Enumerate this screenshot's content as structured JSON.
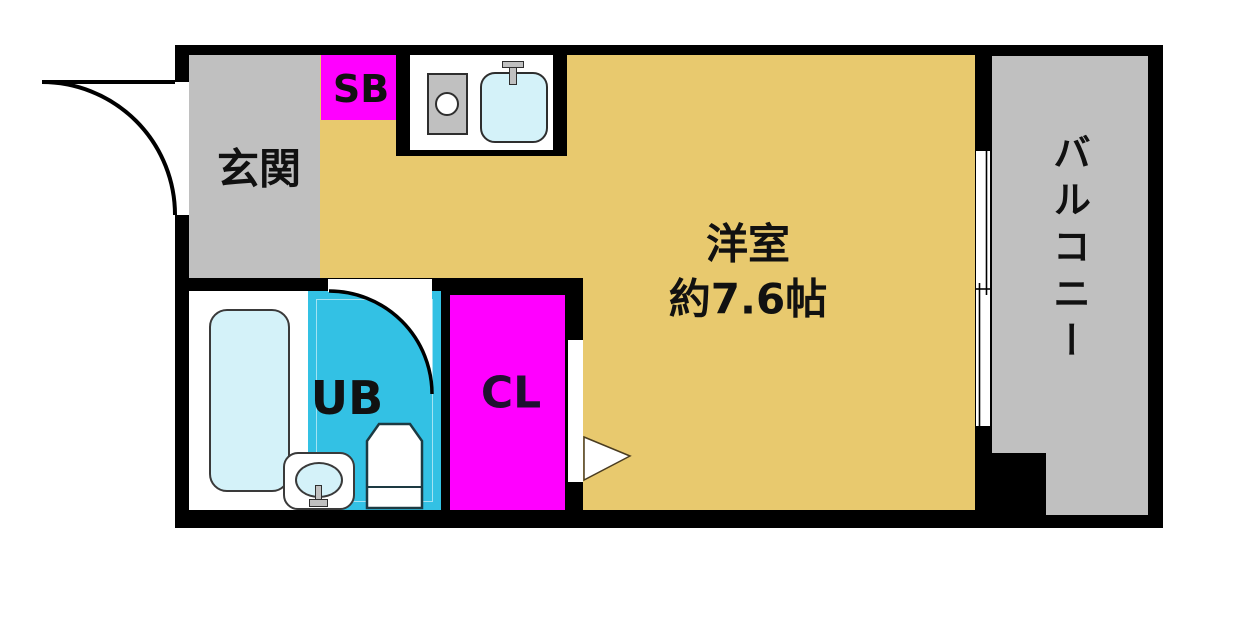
{
  "title": "1R apartment floor plan",
  "rooms": {
    "genkan": {
      "label": "玄関"
    },
    "shoe_box": {
      "label": "SB"
    },
    "unit_bath": {
      "label": "UB"
    },
    "closet": {
      "label": "CL"
    },
    "main_room": {
      "label": "洋室",
      "size_label": "約7.6帖"
    },
    "balcony": {
      "label": "バルコニー"
    }
  },
  "fixtures": {
    "kitchen_sink": "sink-basin-with-faucet",
    "stove": "single-burner-stove",
    "bathtub": "bathtub",
    "toilet": "toilet",
    "washbasin": "washbasin-with-faucet",
    "entrance_door": "outward-door-swing-arc",
    "unit_bath_door": "inward-door-swing-arc",
    "window": "sliding-window",
    "closet_door_arrow": "door-direction-arrow"
  },
  "colors": {
    "wall": "#000000",
    "room_floor": "#e8c96e",
    "genkan_floor": "#c0c0c0",
    "balcony_floor": "#c0c0c0",
    "accent_magenta": "#ff00ff",
    "unit_bath_floor": "#33c1e4",
    "fixture_water": "#d4f2f9",
    "counter_white": "#ffffff",
    "metal_gray": "#c0c0c0"
  }
}
